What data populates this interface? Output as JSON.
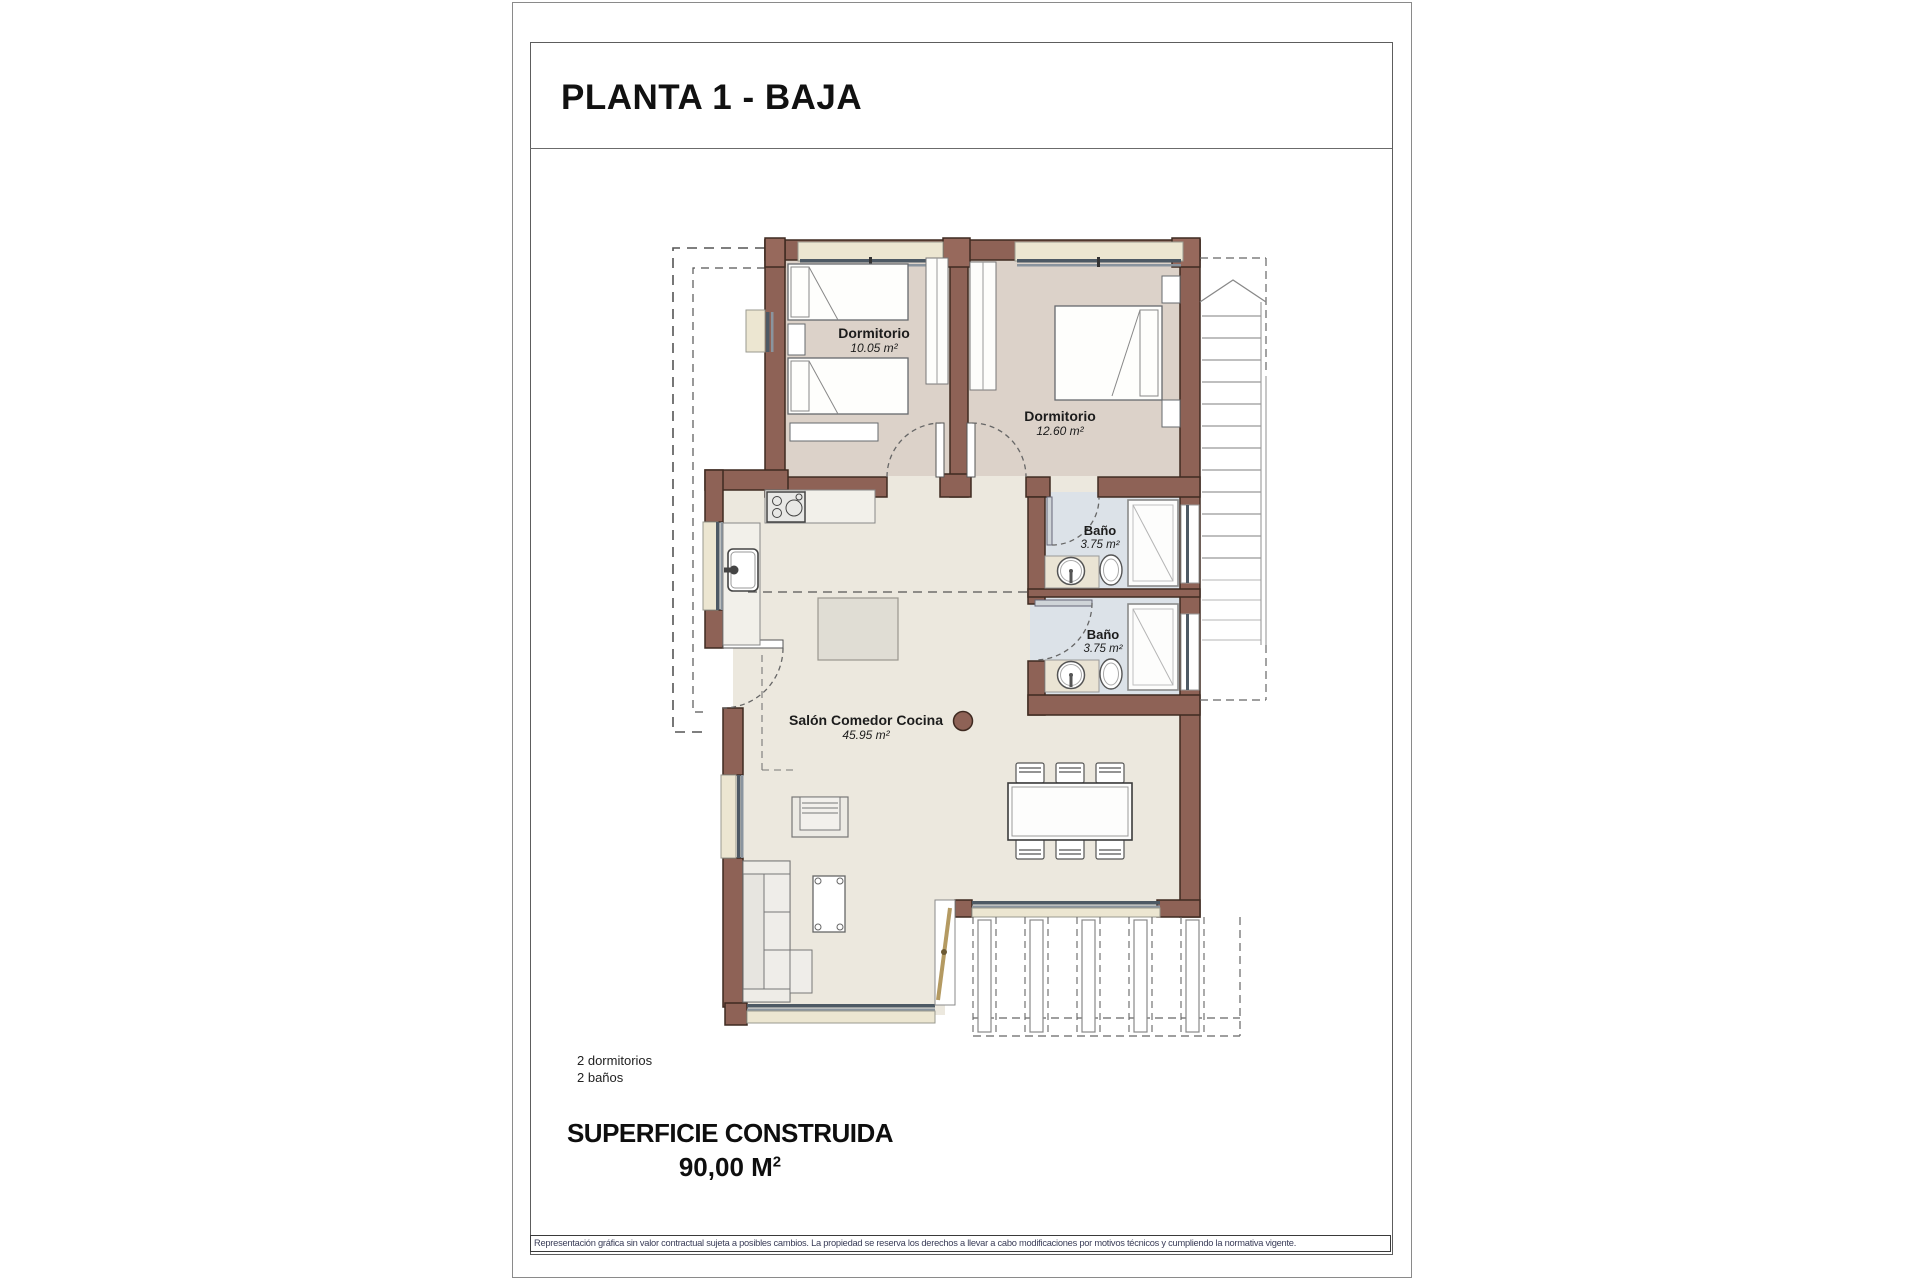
{
  "header": {
    "title": "PLANTA 1 - BAJA"
  },
  "plan": {
    "rooms": [
      {
        "id": "dormitorio-1",
        "name": "Dormitorio",
        "area": "10.05 m²"
      },
      {
        "id": "dormitorio-2",
        "name": "Dormitorio",
        "area": "12.60 m²"
      },
      {
        "id": "bano-1",
        "name": "Baño",
        "area": "3.75 m²"
      },
      {
        "id": "bano-2",
        "name": "Baño",
        "area": "3.75 m²"
      },
      {
        "id": "salon",
        "name": "Salón Comedor Cocina",
        "area": "45.95 m²"
      }
    ]
  },
  "summary": {
    "line1": "2 dormitorios",
    "line2": "2 baños"
  },
  "footer": {
    "area_heading": "SUPERFICIE CONSTRUIDA",
    "area_value": "90,00 M",
    "area_sup": "2",
    "disclaimer": "Representación gráfica sin valor contractual sujeta a posibles cambios. La propiedad se reserva los derechos a llevar a cabo modificaciones por motivos técnicos y cumpliendo la normativa vigente."
  },
  "colors": {
    "wall": "#8e6256",
    "wall_outline": "#3f2a21",
    "bedroom_floor": "#dcd2c9",
    "living_floor": "#ece8de",
    "bath_floor": "#dce2e8",
    "window_sill": "#ece6d1",
    "glass": "#4d5964"
  }
}
